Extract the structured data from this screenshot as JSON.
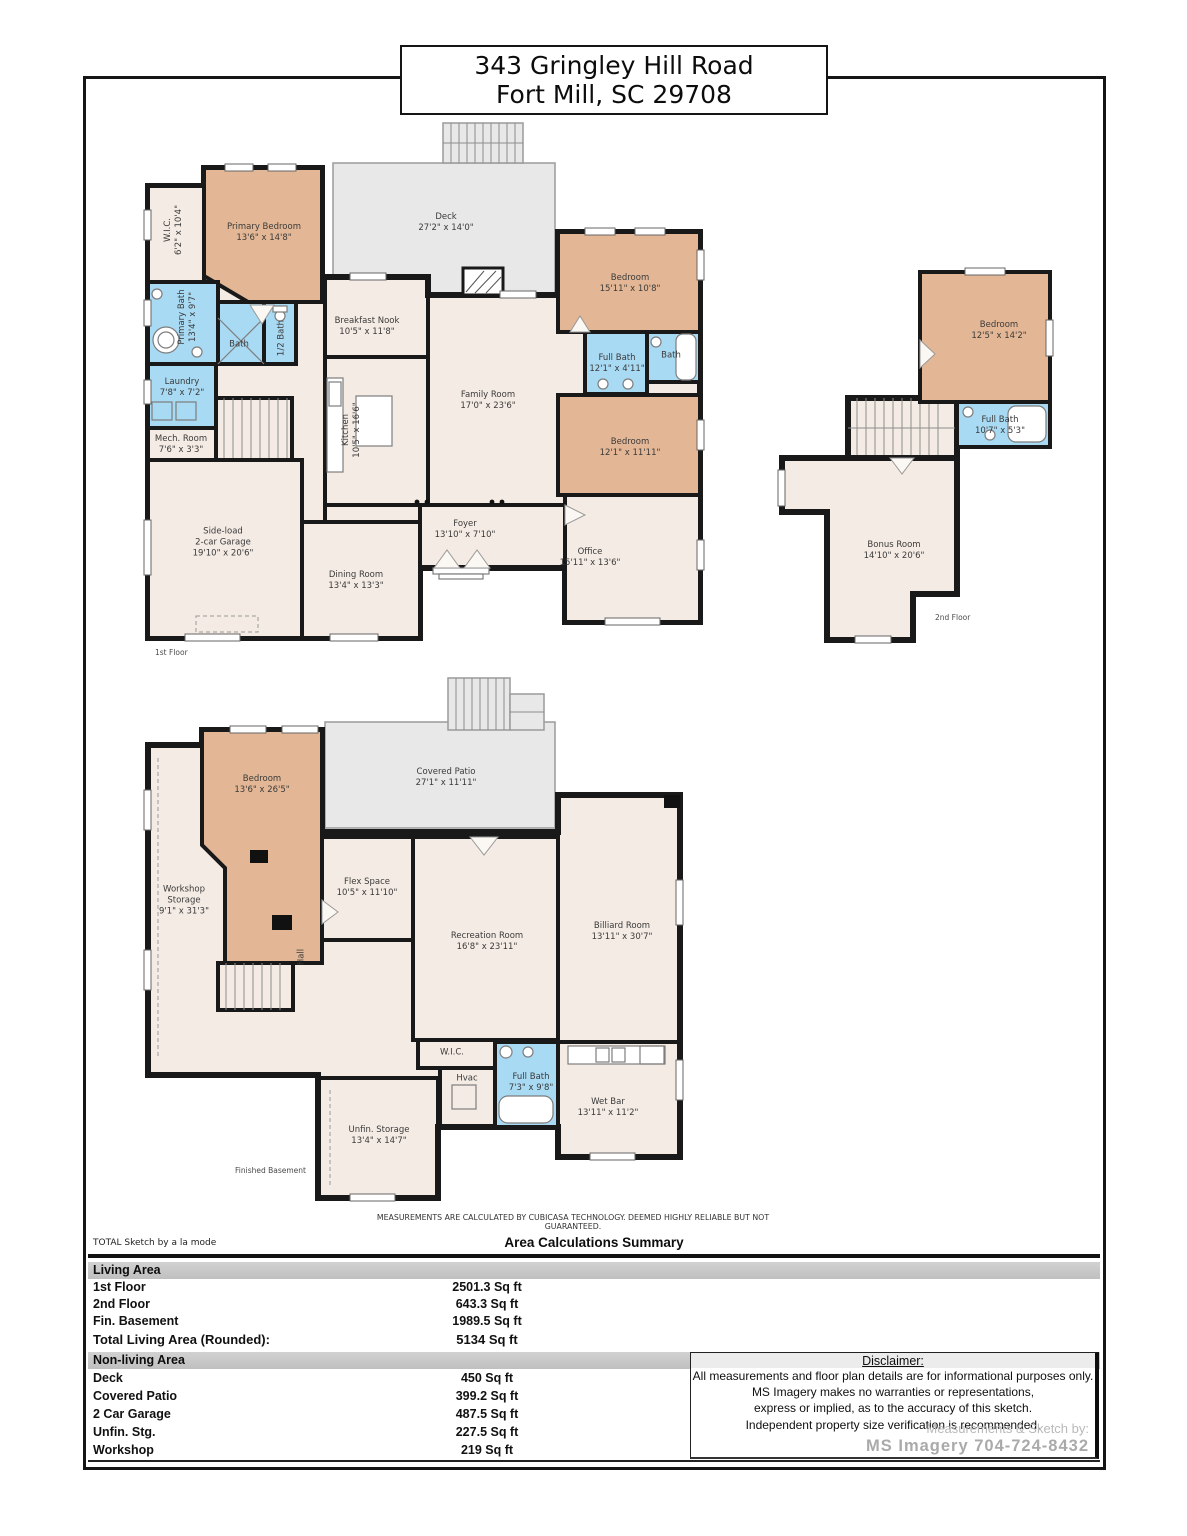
{
  "title": {
    "line1": "343 Gringley Hill Road",
    "line2": "Fort Mill, SC 29708"
  },
  "colors": {
    "bedroom": "#e3b795",
    "bath": "#a9daf3",
    "floor": "#f4ebe4",
    "patio": "#e8e8e8",
    "wall": "#191919"
  },
  "floors": {
    "first": {
      "caption": "1st Floor",
      "rooms": [
        {
          "name": "W.I.C.",
          "dims": "6'2\" x 10'4\""
        },
        {
          "name": "Primary Bedroom",
          "dims": "13'6\" x 14'8\""
        },
        {
          "name": "Deck",
          "dims": "27'2\" x 14'0\""
        },
        {
          "name": "Bedroom",
          "dims": "15'11\" x 10'8\""
        },
        {
          "name": "Primary Bath",
          "dims": "13'4\" x 9'7\""
        },
        {
          "name": "Bath"
        },
        {
          "name": "1/2 Bath"
        },
        {
          "name": "Breakfast Nook",
          "dims": "10'5\" x 11'8\""
        },
        {
          "name": "Full Bath",
          "dims": "12'1\" x 4'11\""
        },
        {
          "name": "Bath"
        },
        {
          "name": "Laundry",
          "dims": "7'8\" x 7'2\""
        },
        {
          "name": "Family Room",
          "dims": "17'0\" x 23'6\""
        },
        {
          "name": "Kitchen",
          "dims": "10'5\" x 16'6\""
        },
        {
          "name": "Mech. Room",
          "dims": "7'6\" x 3'3\""
        },
        {
          "name": "Bedroom",
          "dims": "12'1\" x 11'11\""
        },
        {
          "name": "Side-load",
          "name2": "2-car Garage",
          "dims": "19'10\" x 20'6\""
        },
        {
          "name": "Foyer",
          "dims": "13'10\" x 7'10\""
        },
        {
          "name": "Dining Room",
          "dims": "13'4\" x 13'3\""
        },
        {
          "name": "Office",
          "dims": "15'11\" x 13'6\""
        }
      ]
    },
    "second": {
      "caption": "2nd Floor",
      "rooms": [
        {
          "name": "Bedroom",
          "dims": "12'5\" x 14'2\""
        },
        {
          "name": "Full Bath",
          "dims": "10'7\" x 5'3\""
        },
        {
          "name": "Bonus Room",
          "dims": "14'10\" x 20'6\""
        }
      ]
    },
    "basement": {
      "caption": "Finished Basement",
      "rooms": [
        {
          "name": "Bedroom",
          "dims": "13'6\" x 26'5\""
        },
        {
          "name": "Covered Patio",
          "dims": "27'1\" x 11'11\""
        },
        {
          "name": "Workshop",
          "name2": "Storage",
          "dims": "9'1\" x 31'3\""
        },
        {
          "name": "Flex Space",
          "dims": "10'5\" x 11'10\""
        },
        {
          "name": "Recreation Room",
          "dims": "16'8\" x 23'11\""
        },
        {
          "name": "Billiard Room",
          "dims": "13'11\" x 30'7\""
        },
        {
          "name": "Hall"
        },
        {
          "name": "W.I.C."
        },
        {
          "name": "Hvac"
        },
        {
          "name": "Full Bath",
          "dims": "7'3\" x 9'8\""
        },
        {
          "name": "Wet Bar",
          "dims": "13'11\" x 11'2\""
        },
        {
          "name": "Unfin. Storage",
          "dims": "13'4\" x 14'7\""
        }
      ]
    }
  },
  "notes": {
    "cubicasa": "MEASUREMENTS ARE CALCULATED BY CUBICASA TECHNOLOGY. DEEMED HIGHLY RELIABLE BUT NOT GUARANTEED."
  },
  "summary": {
    "brand": "TOTAL Sketch by a la mode",
    "title": "Area Calculations Summary",
    "living": {
      "header": "Living Area",
      "rows": [
        {
          "label": "1st Floor",
          "value": "2501.3 Sq ft"
        },
        {
          "label": "2nd Floor",
          "value": "643.3 Sq ft"
        },
        {
          "label": "Fin. Basement",
          "value": "1989.5 Sq ft"
        }
      ],
      "total_label": "Total Living Area (Rounded):",
      "total_value": "5134 Sq ft"
    },
    "nonliving": {
      "header": "Non-living Area",
      "rows": [
        {
          "label": "Deck",
          "value": "450 Sq ft"
        },
        {
          "label": "Covered Patio",
          "value": "399.2 Sq ft"
        },
        {
          "label": "2 Car Garage",
          "value": "487.5 Sq ft"
        },
        {
          "label": "Unfin. Stg.",
          "value": "227.5 Sq ft"
        },
        {
          "label": "Workshop",
          "value": "219 Sq ft"
        }
      ]
    }
  },
  "disclaimer": {
    "heading": "Disclaimer:",
    "lines": [
      "All measurements and floor plan details are for informational purposes only.",
      "MS Imagery makes no warranties or representations,",
      "express or implied, as to the accuracy of this sketch.",
      "Independent property size verification is recommended."
    ],
    "credit_label": "Measurements & Sketch by:",
    "credit_value": "MS Imagery  704-724-8432"
  }
}
